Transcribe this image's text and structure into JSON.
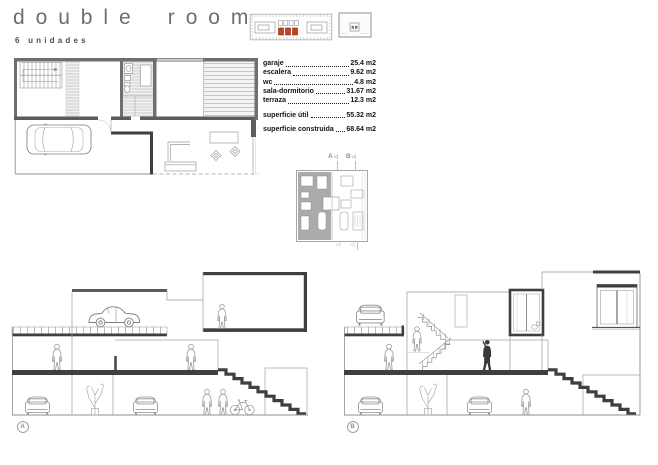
{
  "header": {
    "title": "double room",
    "subtitle": "6 unidades"
  },
  "area_table": {
    "rows": [
      {
        "label": "garaje",
        "value": "25.4 m2"
      },
      {
        "label": "escalera",
        "value": "9.62 m2"
      },
      {
        "label": "wc",
        "value": "4.8 m2"
      },
      {
        "label": "sala-dormitorio",
        "value": "31.67 m2"
      },
      {
        "label": "terraza",
        "value": "12.3 m2"
      }
    ],
    "totals": [
      {
        "label": "superficie útil",
        "value": "55.32 m2"
      },
      {
        "label": "superficie construida",
        "value": "68.64 m2"
      }
    ]
  },
  "key_plan": {
    "section_marker_a": "A",
    "section_marker_b": "B",
    "cut_arrow_glyph": "◁"
  },
  "sections": {
    "a_badge": "A",
    "b_badge": "B"
  },
  "colors": {
    "accent_red": "#c2451c",
    "drawing_ink": "#3f3f3f",
    "wall_gray": "#6f6f6f",
    "title_gray": "#6e6e6e"
  }
}
